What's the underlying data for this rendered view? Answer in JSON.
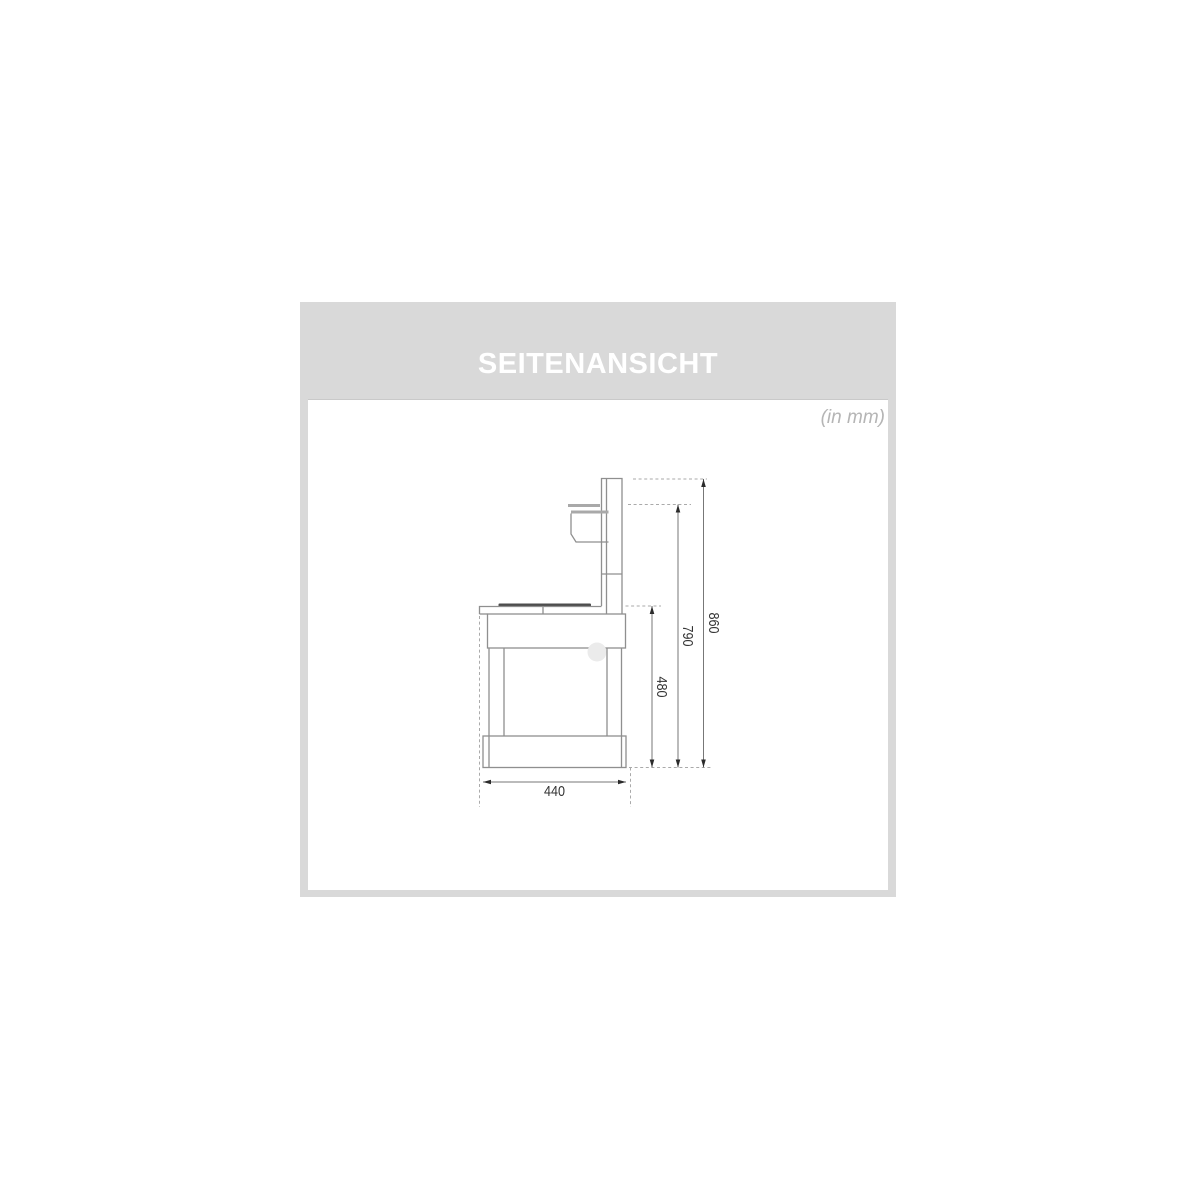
{
  "panel": {
    "title": "SEITENANSICHT",
    "units_note": "(in mm)"
  },
  "drawing": {
    "type": "side-view-technical-drawing",
    "dimensions": {
      "total_height": "860",
      "shelf_height": "790",
      "worktop_height": "480",
      "base_depth": "440"
    },
    "colors": {
      "panel_background": "#d9d9d9",
      "content_background": "#ffffff",
      "title_text": "#ffffff",
      "units_text": "#b5b5b5",
      "outline": "#8f8f8f",
      "countertop_bar": "#4d4d4d",
      "dimension_line": "#777777",
      "dashed_reference": "#aaaaaa",
      "dimension_text": "#333333"
    }
  }
}
